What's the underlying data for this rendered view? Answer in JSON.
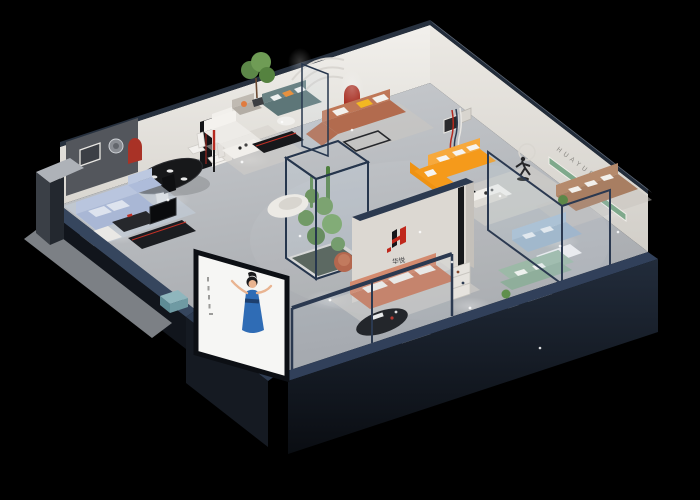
{
  "scene": {
    "title": "3D isometric cutaway render of a furniture showroom floor plan",
    "background_color": "#000000"
  },
  "brand": {
    "wall_text": "HUAYUE",
    "logo_text_cn": "华悦",
    "logo_red": "#c0281c",
    "logo_black": "#16161a"
  },
  "palette": {
    "floor": "#bfc2c6",
    "walls_white": "#eae7e2",
    "cut_wall_navy": "#2e3c52",
    "exterior_dark": "#12161d",
    "arch_red": "#a93226",
    "sofa_orange": "#f59a1b",
    "sofa_caramel": "#b26b4e",
    "sofa_terracotta": "#c87d61",
    "sofa_blue": "#aab8d6",
    "sofa_teal": "#5e7779",
    "sofa_green": "#9cb9a7",
    "sofa_tan": "#a87e62",
    "plant_green": "#5f8f4c",
    "shelf_green": "#7fa98c",
    "hostess_dress_blue": "#2f6cb5"
  },
  "zones": [
    "entry-display-screen-hostess",
    "blue-fabric-living-set",
    "dining-set",
    "white-living-set",
    "teal-sofa-set",
    "caramel-sectional-set",
    "orange-sectional-set",
    "indoor-plant-atrium",
    "brand-logo-wall",
    "tan-leather-sofa-set",
    "glass-sofa-gallery-blue-green",
    "terracotta-sofa-set",
    "bedroom-gray-set"
  ]
}
